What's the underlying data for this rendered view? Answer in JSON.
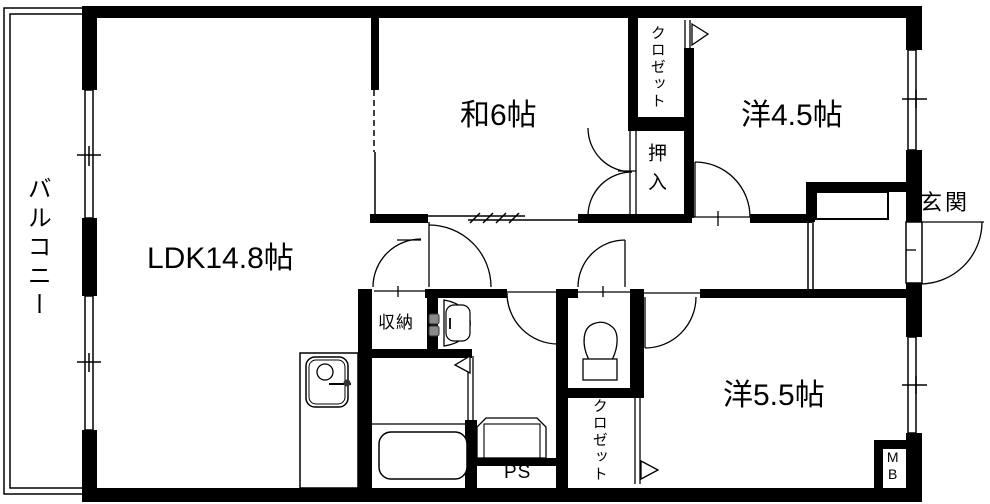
{
  "title": "apartment floor plan",
  "colors": {
    "line": "#000000",
    "background": "#ffffff",
    "fixture_knob": "#8a8a8a"
  },
  "rooms": {
    "balcony": {
      "label": "バルコニー"
    },
    "ldk": {
      "label": "LDK14.8帖"
    },
    "japanese_room": {
      "label": "和6帖"
    },
    "western_room_45": {
      "label": "洋4.5帖"
    },
    "western_room_55": {
      "label": "洋5.5帖"
    },
    "entrance": {
      "label": "玄関"
    },
    "closet_north": {
      "label": "クロゼット"
    },
    "closet_south": {
      "label": "クロゼット"
    },
    "oshiire": {
      "label": "押入"
    },
    "storage": {
      "label": "収納"
    },
    "pipe_space": {
      "label": "PS"
    },
    "meter_box": {
      "label": "MB"
    }
  }
}
